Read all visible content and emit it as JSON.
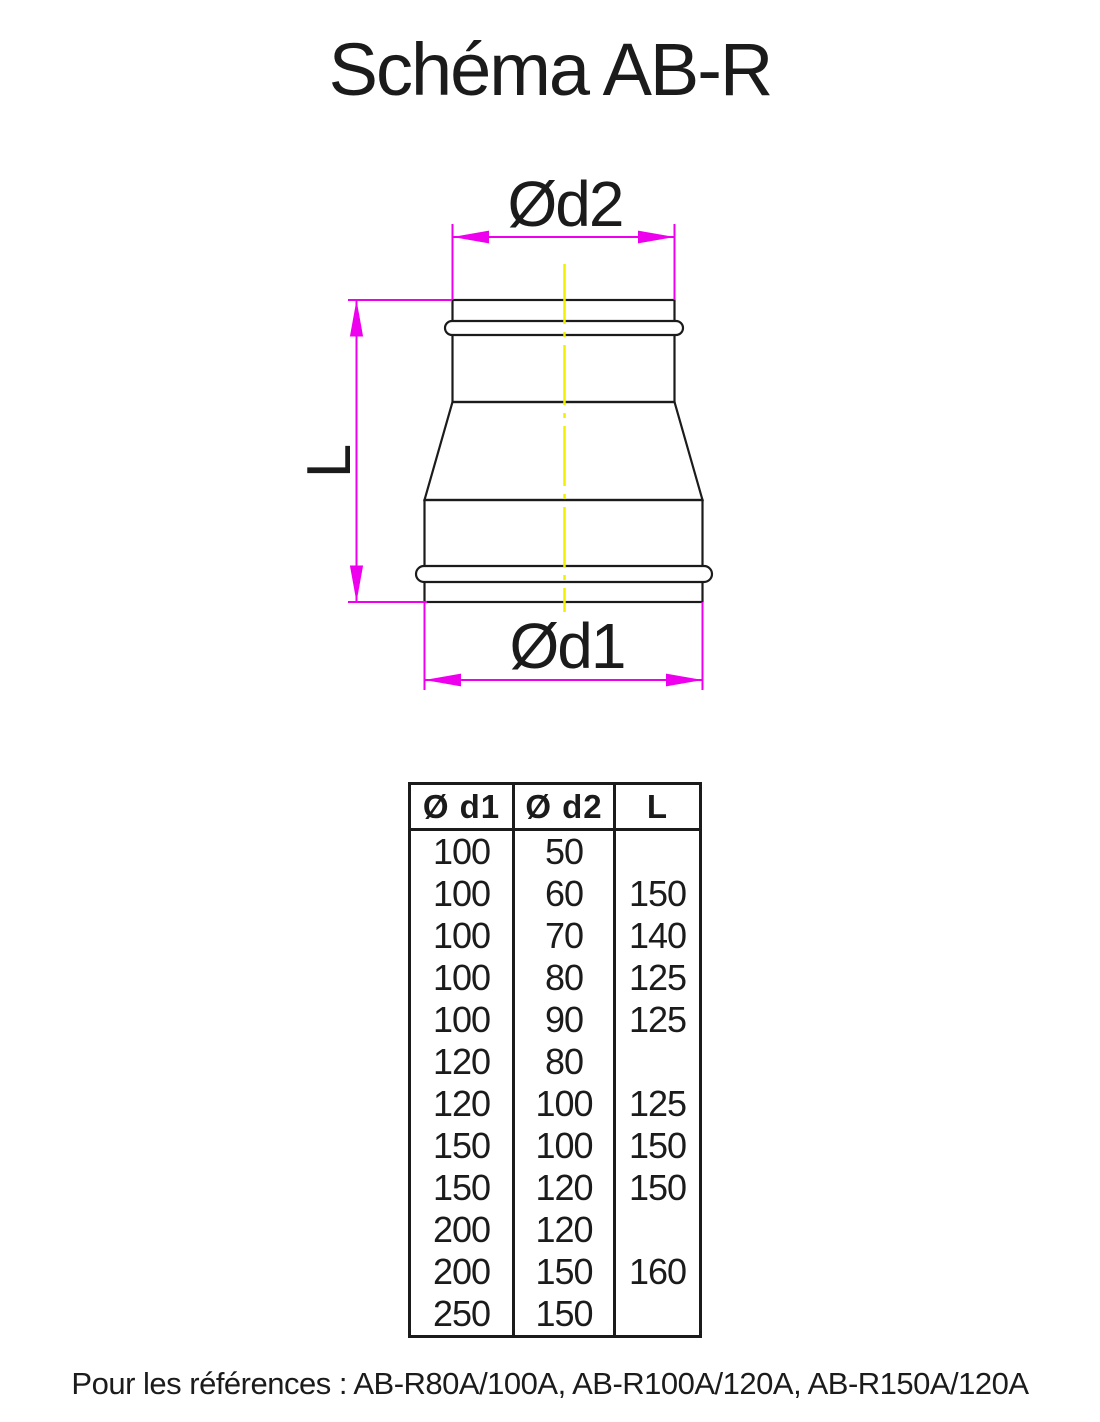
{
  "title": "Schéma AB-R",
  "diagram": {
    "top_dimension_label": "Ød2",
    "left_dimension_label": "L",
    "bottom_dimension_label": "Ød1",
    "colors": {
      "dimension_lines": "#EE00EE",
      "centerline": "#F0F000",
      "outline": "#1B1B1B"
    }
  },
  "table": {
    "headers": [
      "Ø d1",
      "Ø d2",
      "L"
    ],
    "rows": [
      [
        "100",
        "50",
        ""
      ],
      [
        "100",
        "60",
        "150"
      ],
      [
        "100",
        "70",
        "140"
      ],
      [
        "100",
        "80",
        "125"
      ],
      [
        "100",
        "90",
        "125"
      ],
      [
        "120",
        "80",
        ""
      ],
      [
        "120",
        "100",
        "125"
      ],
      [
        "150",
        "100",
        "150"
      ],
      [
        "150",
        "120",
        "150"
      ],
      [
        "200",
        "120",
        ""
      ],
      [
        "200",
        "150",
        "160"
      ],
      [
        "250",
        "150",
        ""
      ]
    ]
  },
  "footer": {
    "text": "Pour les références : AB-R80A/100A, AB-R100A/120A, AB-R150A/120A"
  }
}
